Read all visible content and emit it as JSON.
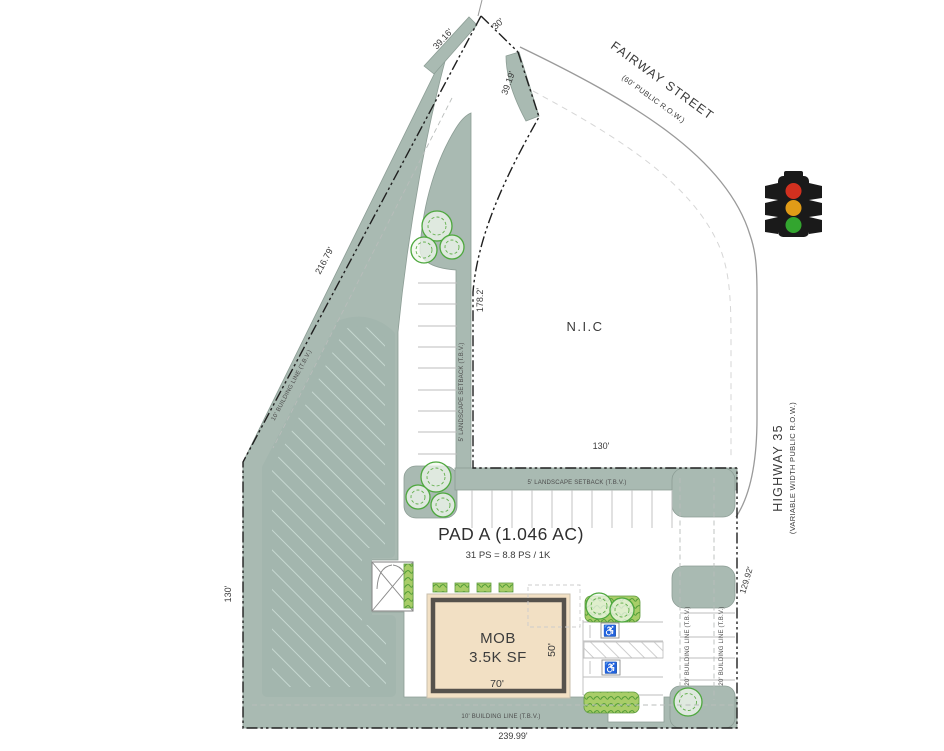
{
  "plan": {
    "streets": {
      "fairway": {
        "name": "FAIRWAY STREET",
        "row": "(60' PUBLIC R.O.W.)"
      },
      "highway": {
        "name": "HIGHWAY 35",
        "row": "(VARIABLE WIDTH PUBLIC R.O.W.)"
      }
    },
    "parcel": {
      "title": "PAD A (1.046 AC)",
      "parking_ratio": "31 PS = 8.8 PS / 1K",
      "nic": "N.I.C"
    },
    "building": {
      "name": "MOB",
      "area": "3.5K SF",
      "width": "70'",
      "depth": "50'"
    },
    "dimensions": {
      "d39_16": "39.16'",
      "d30": "30'",
      "d39_19": "39.19'",
      "d216_79": "216.79'",
      "d178_2": "178.2'",
      "d130_top": "130'",
      "d130_left": "130'",
      "d239_99": "239.99'",
      "d129_92": "129.92'"
    },
    "setbacks": {
      "landscape_v": "5' LANDSCAPE SETBACK (T.B.V.)",
      "landscape_h": "5' LANDSCAPE SETBACK (T.B.V.)",
      "building_diag": "10' BUILDING LINE (T.B.V.)",
      "building_bottom": "10' BUILDING LINE (T.B.V.)",
      "building_right_inner": "20' BUILDING LINE (T.B.V.)",
      "building_right_outer": "20' BUILDING LINE (T.B.V.)"
    },
    "icons": {
      "traffic_signal": "traffic-light-icon",
      "tree": "tree-icon",
      "accessible_parking_glyph": "♿",
      "dumpster": "dumpster-enclosure-icon"
    },
    "colors": {
      "landscape": "#a9bab2",
      "hatch_line": "#cfe0d9",
      "building_fill": "#f2e0c4",
      "building_frame": "#56524c",
      "hedge": "#9fc860",
      "tree": "#4ea83e",
      "signal_red": "#d2301f",
      "signal_amber": "#e09b17",
      "signal_green": "#33a52f",
      "property_line": "#1f1f1f"
    }
  }
}
